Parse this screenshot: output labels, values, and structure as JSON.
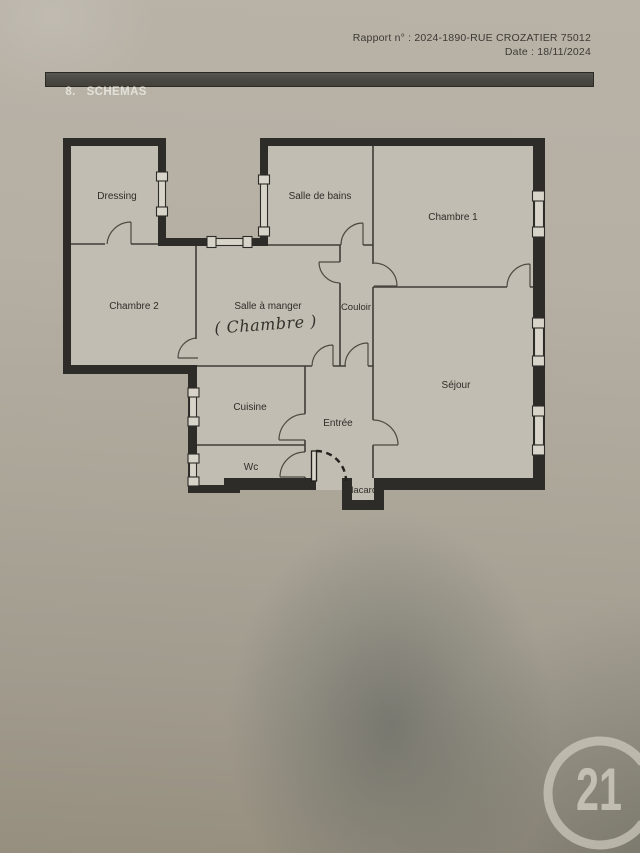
{
  "page": {
    "report_line": "Rapport n° : 2024-1890-RUE CROZATIER 75012",
    "date_line": "Date : 18/11/2024"
  },
  "header": {
    "section_title": "8.   SCHEMAS"
  },
  "floorplan": {
    "rooms": {
      "dressing": "Dressing",
      "salle_de_bains": "Salle de bains",
      "chambre1": "Chambre 1",
      "chambre2": "Chambre 2",
      "salle_a_manger": "Salle à manger",
      "salle_a_manger_annotation": "( Chambre )",
      "couloir": "Couloir",
      "sejour": "Séjour",
      "cuisine": "Cuisine",
      "entree": "Entrée",
      "wc": "Wc",
      "placard": "Placard"
    }
  },
  "watermark": {
    "logo_text": "21"
  },
  "colors": {
    "paper": "#aca699",
    "wall": "#2e2c28",
    "room": "#c2bdb2",
    "bar": "#4a4843",
    "logo": "#d3cfc3",
    "ink": "#3c3a35"
  }
}
